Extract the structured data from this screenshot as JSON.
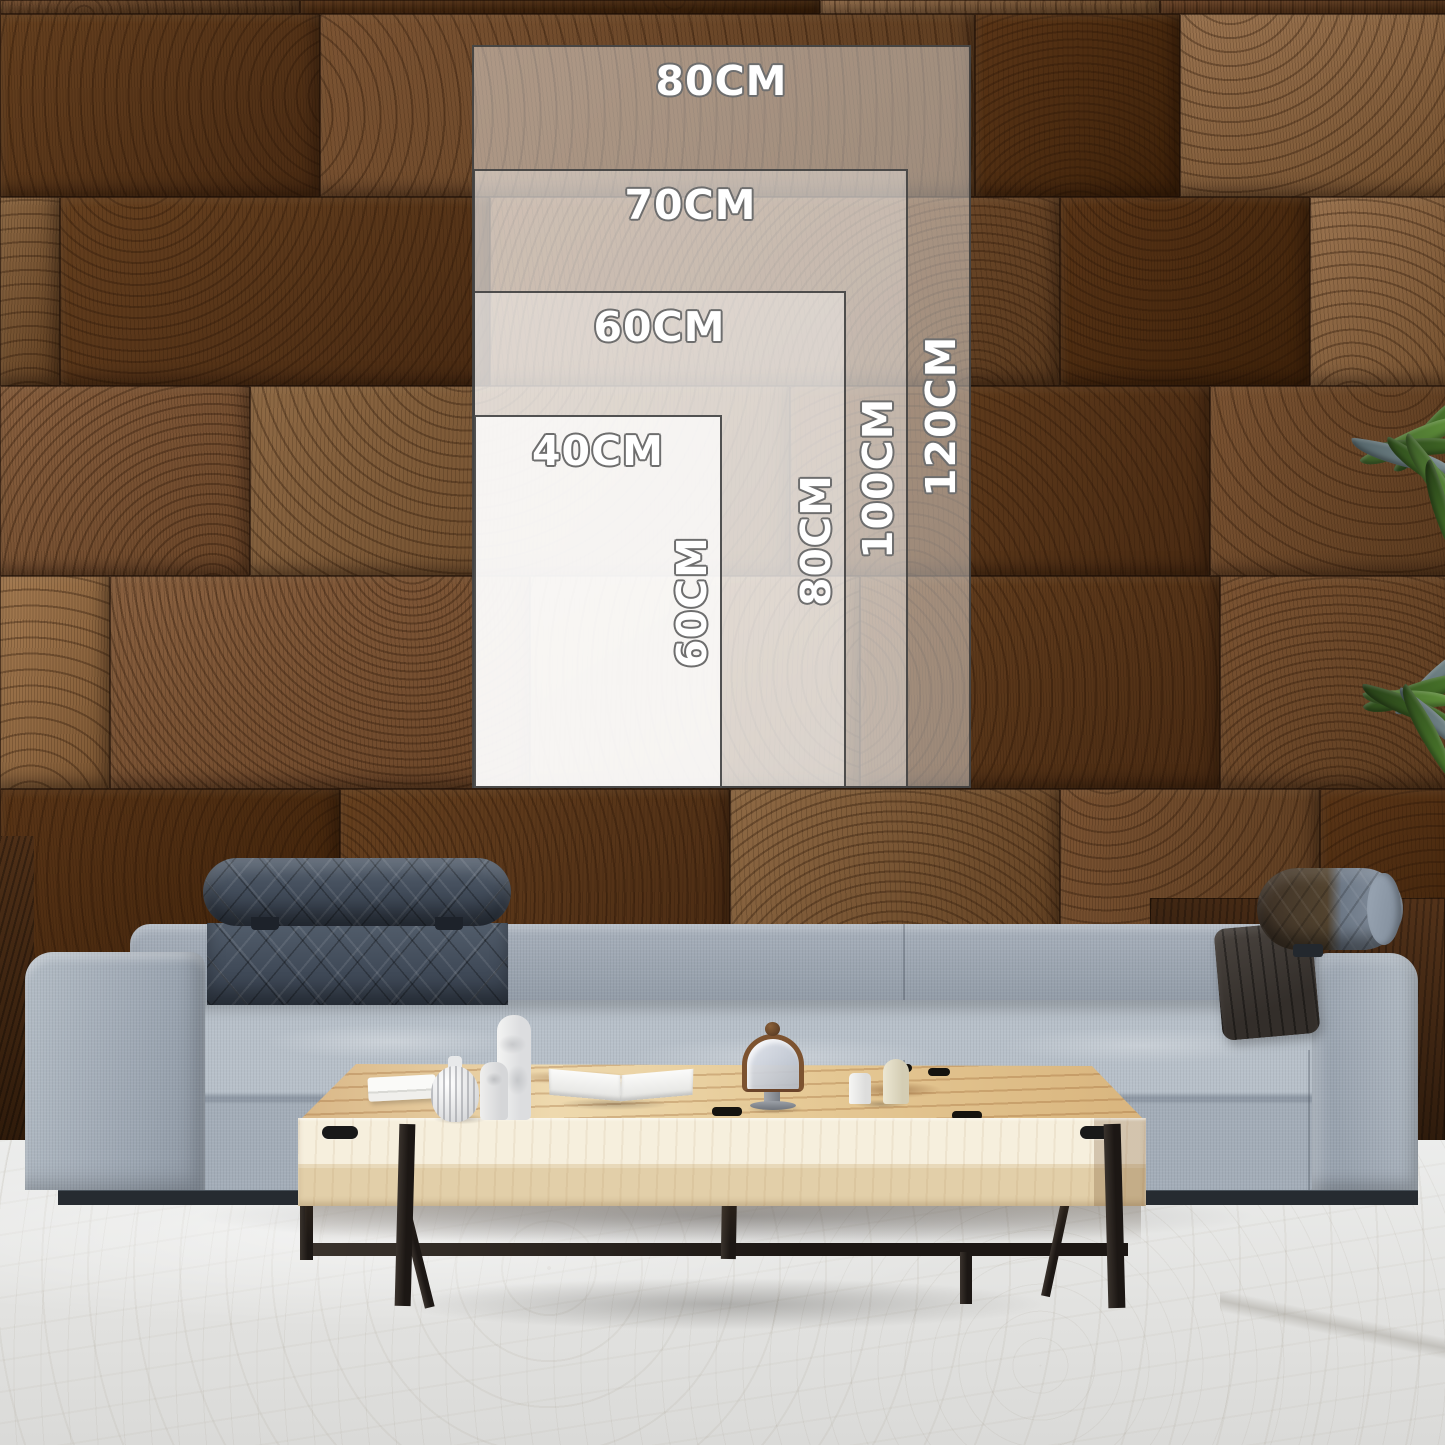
{
  "page_type": "product wall-art size guide",
  "size_guide": {
    "unit": "CM",
    "sizes": [
      {
        "width_label": "80CM",
        "height_label": "120CM"
      },
      {
        "width_label": "70CM",
        "height_label": "100CM"
      },
      {
        "width_label": "60CM",
        "height_label": "80CM"
      },
      {
        "width_label": "40CM",
        "height_label": "60CM"
      }
    ],
    "text_color": "#ffffff",
    "outline_color": "#6e6e6e",
    "border_color": "#3a3a3a"
  },
  "scene": {
    "wall_color": "#7a5130",
    "sofa_color": "#9aa4b0",
    "headrest_color": "#414b59",
    "leather_pillow_color": "#4a3a2c",
    "table_wood_color": "#e7cfa3",
    "table_face_color": "#f3ecd9",
    "metal_leg_color": "#26211d",
    "floor_color": "#e9e9e7",
    "plant_color": "#3f6623"
  }
}
